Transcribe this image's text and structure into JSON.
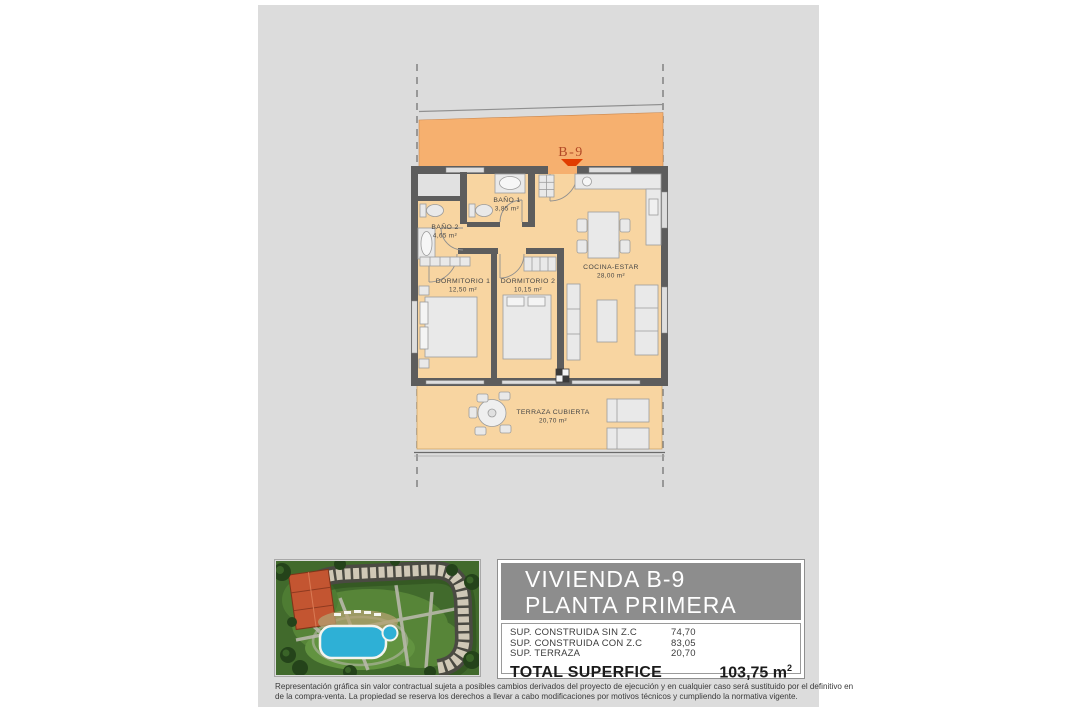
{
  "plan": {
    "unit_label": "B-9",
    "rooms": {
      "bano1": {
        "name": "BAÑO 1",
        "area": "3,85 m²"
      },
      "bano2": {
        "name": "BAÑO 2",
        "area": "4,65 m²"
      },
      "dorm1": {
        "name": "DORMITORIO 1",
        "area": "12,50 m²"
      },
      "dorm2": {
        "name": "DORMITORIO 2",
        "area": "10,15 m²"
      },
      "cocina": {
        "name": "COCINA-ESTAR",
        "area": "28,00 m²"
      },
      "terraza": {
        "name": "TERRAZA CUBIERTA",
        "area": "20,70 m²"
      }
    },
    "colors": {
      "corridor_orange": "#f6b06f",
      "room_floor": "#f8d5a1",
      "wall": "#5d5d5d",
      "panel_gray": "#dcdcdc",
      "marker_red": "#e13d00"
    }
  },
  "title_block": {
    "title_line1": "VIVIENDA B-9",
    "title_line2": "PLANTA PRIMERA",
    "rows": [
      {
        "label": "SUP. CONSTRUIDA SIN Z.C",
        "value": "74,70"
      },
      {
        "label": "SUP. CONSTRUIDA CON Z.C",
        "value": "83,05"
      },
      {
        "label": "SUP. TERRAZA",
        "value": "20,70"
      }
    ],
    "total_label": "TOTAL SUPERFICE",
    "total_value": "103,75 m",
    "total_sup": "2"
  },
  "disclaimer": {
    "line1": "Representación gráfica sin valor contractual sujeta a posibles cambios derivados del proyecto de ejecución y en cualquier caso será sustituido por el definitivo en",
    "line2": "de la compra-venta. La propiedad se reserva los derechos a llevar a cabo modificaciones por motivos técnicos y cumpliendo la normativa vigente."
  }
}
